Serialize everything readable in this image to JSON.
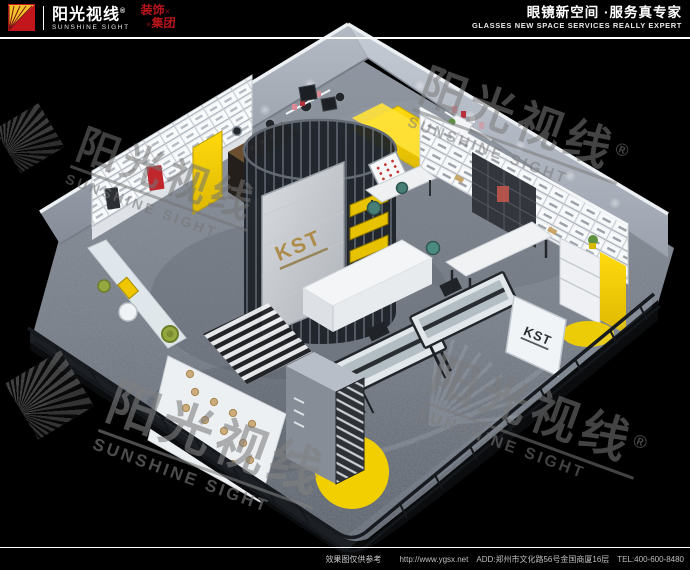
{
  "header": {
    "logo": {
      "brand_cn": "阳光视线",
      "registered_mark": "®",
      "brand_en": "SUNSHINE SIGHT",
      "group_word_1": "装饰",
      "group_word_2": "集团",
      "group_mark": "✕"
    },
    "slogan_cn": "眼镜新空间 ·服务真专家",
    "slogan_en": "GLASSES NEW SPACE SERVICES REALLY EXPERT"
  },
  "footer": {
    "disclaimer": "效果图仅供参考",
    "url": "http://www.ygsx.net",
    "address": "ADD:郑州市文化路56号金国商厦16层",
    "tel": "TEL:400-600-8480"
  },
  "watermark": {
    "brand_cn": "阳光视线",
    "brand_en": "SUNSHINE SIGHT",
    "registered_mark": "®"
  },
  "scene": {
    "store_brand": "KST",
    "colors": {
      "accent_yellow": "#f2cf00",
      "logo_red": "#c3161c",
      "floor_gray": "#79808a",
      "wall_gray": "#a9b0ba",
      "cage_dark": "#1d2127",
      "kst_gold": "#ad8c4b"
    }
  }
}
